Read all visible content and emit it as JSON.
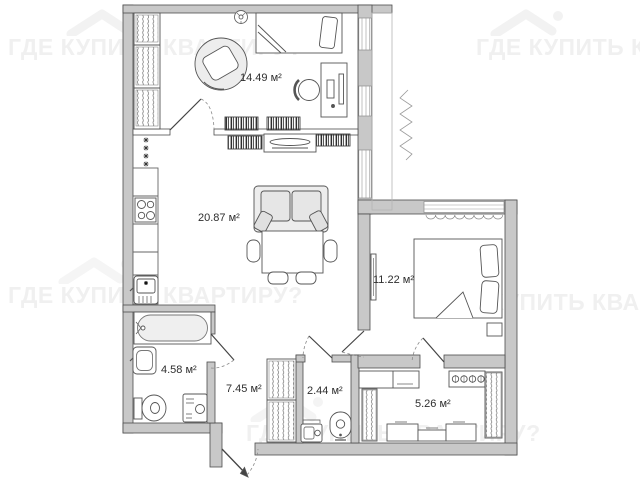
{
  "watermark": {
    "text": "ГДЕ КУПИТЬ КВАРТИРУ?",
    "color": "#f0f0f0"
  },
  "plan": {
    "type": "apartment-floor-plan",
    "rooms": [
      {
        "id": "room-1449",
        "name": "bedroom-top",
        "area_m2": 14.49,
        "label": "14.49 м²"
      },
      {
        "id": "room-2087",
        "name": "living-room",
        "area_m2": 20.87,
        "label": "20.87 м²"
      },
      {
        "id": "room-1122",
        "name": "bedroom-right",
        "area_m2": 11.22,
        "label": "11.22 м²"
      },
      {
        "id": "room-458",
        "name": "bathroom",
        "area_m2": 4.58,
        "label": "4.58 м²"
      },
      {
        "id": "room-745",
        "name": "hallway",
        "area_m2": 7.45,
        "label": "7.45 м²"
      },
      {
        "id": "room-244",
        "name": "wc",
        "area_m2": 2.44,
        "label": "2.44 м²"
      },
      {
        "id": "room-526",
        "name": "kitchen",
        "area_m2": 5.26,
        "label": "5.26 м²"
      }
    ],
    "colors": {
      "wall": "#c8c8c8",
      "wall_outline": "#4d4d4d",
      "furniture_line": "#555555",
      "watermark": "#f0f0f0"
    }
  }
}
